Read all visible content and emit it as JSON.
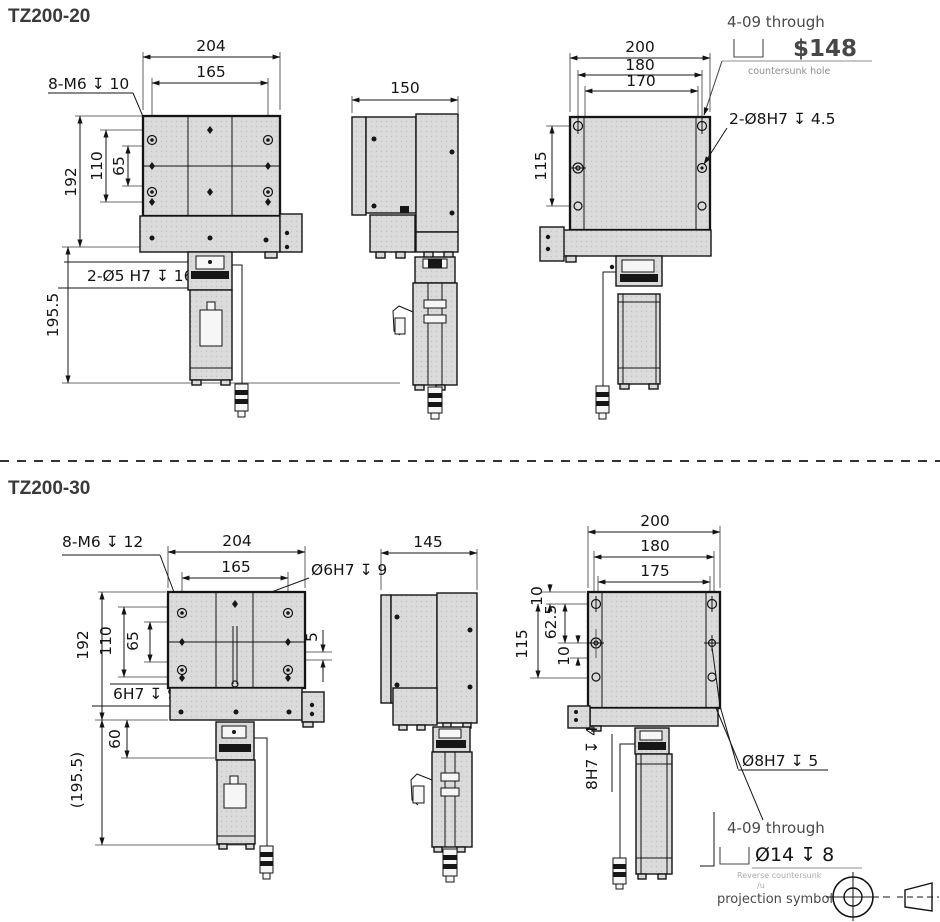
{
  "colors": {
    "line": "#141414",
    "part_fill": "#d8d8d8",
    "annotation": "#4a4a4a",
    "muted": "#8f8f8f"
  },
  "m20": {
    "title": "TZ200-20",
    "front": {
      "w204": "204",
      "w165": "165",
      "holes_note": "8-M6 ↧ 10",
      "h192": "192",
      "h110": "110",
      "h65": "65",
      "pins_note": "2-Ø5 H7 ↧ 16",
      "motor_h": "195.5"
    },
    "side": {
      "w150": "150"
    },
    "back": {
      "w200": "200",
      "w180": "180",
      "w170": "170",
      "h115": "115",
      "through_note": "4-09 through",
      "price": "$148",
      "countersunk_label": "countersunk hole",
      "pins_note": "2-Ø8H7 ↧ 4.5"
    }
  },
  "m30": {
    "title": "TZ200-30",
    "front": {
      "holes_note": "8-M6 ↧ 12",
      "w204": "204",
      "w165": "165",
      "center_hole_note": "Ø6H7 ↧ 9",
      "h192": "192",
      "h110": "110",
      "h65": "65",
      "offset5": "5",
      "bottom_hole_note": "6H7 ↧ 9",
      "h60": "60",
      "motor_h": "(195.5)"
    },
    "side": {
      "w145": "145"
    },
    "back": {
      "w200": "200",
      "w180": "180",
      "w175": "175",
      "t10": "10",
      "h62_5": "62.5",
      "h115": "115",
      "m10": "10",
      "shaft_note": "8H7 ↧ 4",
      "pin_note": "Ø8H7 ↧ 5",
      "through_note": "4-09 through",
      "cbore_note": "Ø14 ↧ 8",
      "reverse_label": "Reverse countersunk",
      "remnant": "∕u",
      "projection_label": "projection symbol"
    }
  }
}
